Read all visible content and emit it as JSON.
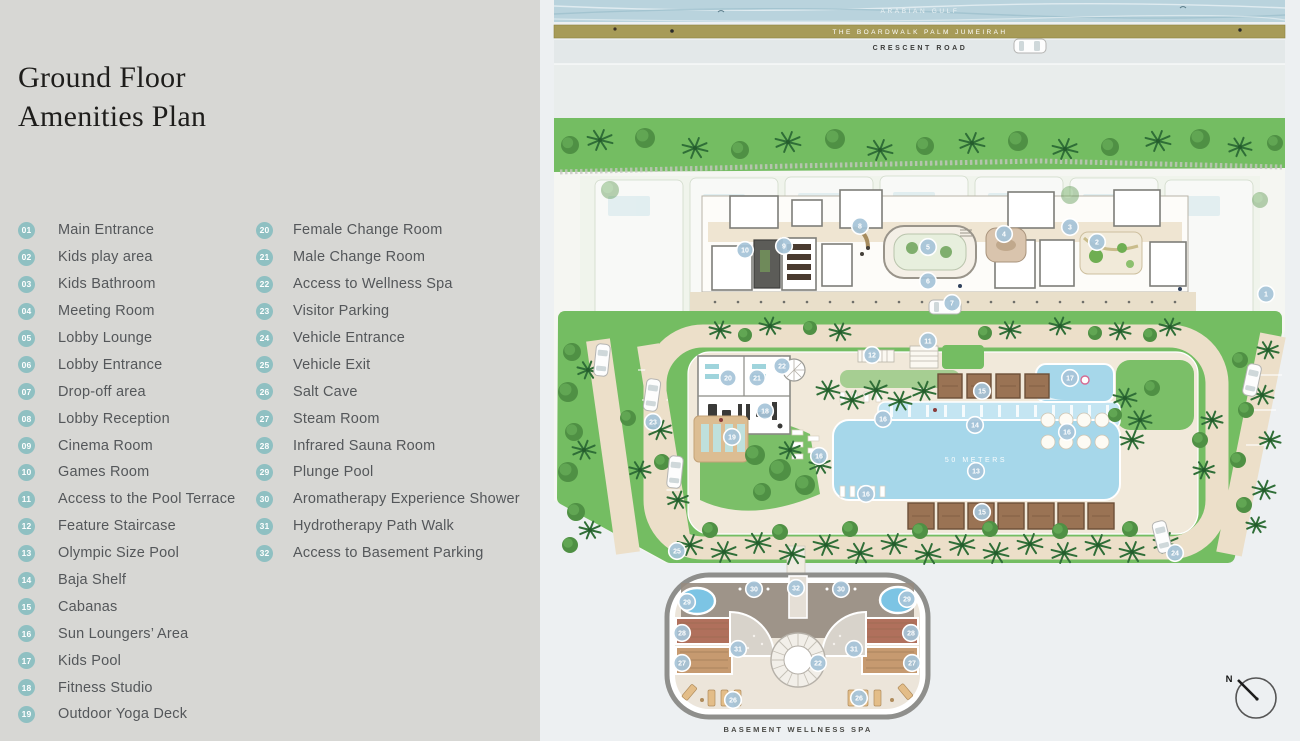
{
  "panel": {
    "title_lines": [
      "Ground Floor",
      "Amenities Plan"
    ]
  },
  "legend": {
    "column1": [
      {
        "num": "01",
        "label": "Main Entrance"
      },
      {
        "num": "02",
        "label": "Kids play area"
      },
      {
        "num": "03",
        "label": "Kids Bathroom"
      },
      {
        "num": "04",
        "label": "Meeting Room"
      },
      {
        "num": "05",
        "label": "Lobby Lounge"
      },
      {
        "num": "06",
        "label": "Lobby Entrance"
      },
      {
        "num": "07",
        "label": "Drop-off area"
      },
      {
        "num": "08",
        "label": "Lobby Reception"
      },
      {
        "num": "09",
        "label": "Cinema Room"
      },
      {
        "num": "10",
        "label": "Games Room"
      },
      {
        "num": "11",
        "label": "Access to the Pool Terrace"
      },
      {
        "num": "12",
        "label": "Feature Staircase"
      },
      {
        "num": "13",
        "label": "Olympic Size Pool"
      },
      {
        "num": "14",
        "label": "Baja Shelf"
      },
      {
        "num": "15",
        "label": "Cabanas"
      },
      {
        "num": "16",
        "label": "Sun Loungers’ Area"
      },
      {
        "num": "17",
        "label": "Kids Pool"
      },
      {
        "num": "18",
        "label": "Fitness Studio"
      },
      {
        "num": "19",
        "label": "Outdoor Yoga Deck"
      }
    ],
    "column2": [
      {
        "num": "20",
        "label": "Female Change Room"
      },
      {
        "num": "21",
        "label": "Male Change Room"
      },
      {
        "num": "22",
        "label": "Access to Wellness Spa"
      },
      {
        "num": "23",
        "label": "Visitor Parking"
      },
      {
        "num": "24",
        "label": "Vehicle Entrance"
      },
      {
        "num": "25",
        "label": "Vehicle Exit"
      },
      {
        "num": "26",
        "label": "Salt Cave"
      },
      {
        "num": "27",
        "label": "Steam Room"
      },
      {
        "num": "28",
        "label": "Infrared Sauna Room"
      },
      {
        "num": "29",
        "label": "Plunge Pool"
      },
      {
        "num": "30",
        "label": "Aromatherapy Experience Shower"
      },
      {
        "num": "31",
        "label": "Hydrotherapy Path Walk"
      },
      {
        "num": "32",
        "label": "Access to Basement Parking"
      }
    ]
  },
  "plan": {
    "water_label": "ARABIAN GULF",
    "boardwalk_label": "THE BOARDWALK PALM JUMEIRAH",
    "road_label": "CRESCENT ROAD",
    "pool_label": "50 METERS",
    "spa_label": "BASEMENT WELLNESS SPA",
    "north_label": "N",
    "markers": [
      {
        "n": "1",
        "x": 726,
        "y": 294
      },
      {
        "n": "2",
        "x": 557,
        "y": 242
      },
      {
        "n": "3",
        "x": 530,
        "y": 227
      },
      {
        "n": "4",
        "x": 464,
        "y": 234
      },
      {
        "n": "5",
        "x": 388,
        "y": 247
      },
      {
        "n": "6",
        "x": 388,
        "y": 281
      },
      {
        "n": "7",
        "x": 412,
        "y": 303
      },
      {
        "n": "8",
        "x": 320,
        "y": 226
      },
      {
        "n": "9",
        "x": 244,
        "y": 246
      },
      {
        "n": "10",
        "x": 205,
        "y": 250
      },
      {
        "n": "11",
        "x": 388,
        "y": 341
      },
      {
        "n": "12",
        "x": 332,
        "y": 355
      },
      {
        "n": "13",
        "x": 436,
        "y": 471
      },
      {
        "n": "14",
        "x": 435,
        "y": 425
      },
      {
        "n": "15",
        "x": 442,
        "y": 391
      },
      {
        "n": "15",
        "x": 442,
        "y": 512
      },
      {
        "n": "16",
        "x": 343,
        "y": 419
      },
      {
        "n": "16",
        "x": 279,
        "y": 456
      },
      {
        "n": "16",
        "x": 527,
        "y": 432
      },
      {
        "n": "16",
        "x": 326,
        "y": 494
      },
      {
        "n": "17",
        "x": 530,
        "y": 378
      },
      {
        "n": "18",
        "x": 225,
        "y": 411
      },
      {
        "n": "19",
        "x": 192,
        "y": 437
      },
      {
        "n": "20",
        "x": 188,
        "y": 378
      },
      {
        "n": "21",
        "x": 217,
        "y": 378
      },
      {
        "n": "22",
        "x": 242,
        "y": 366
      },
      {
        "n": "23",
        "x": 113,
        "y": 422
      },
      {
        "n": "24",
        "x": 635,
        "y": 553
      },
      {
        "n": "25",
        "x": 137,
        "y": 551
      },
      {
        "n": "26",
        "x": 193,
        "y": 700
      },
      {
        "n": "26",
        "x": 319,
        "y": 698
      },
      {
        "n": "27",
        "x": 142,
        "y": 663
      },
      {
        "n": "27",
        "x": 372,
        "y": 663
      },
      {
        "n": "28",
        "x": 142,
        "y": 633
      },
      {
        "n": "28",
        "x": 371,
        "y": 633
      },
      {
        "n": "29",
        "x": 147,
        "y": 602
      },
      {
        "n": "29",
        "x": 367,
        "y": 599
      },
      {
        "n": "30",
        "x": 214,
        "y": 589
      },
      {
        "n": "30",
        "x": 301,
        "y": 589
      },
      {
        "n": "31",
        "x": 198,
        "y": 649
      },
      {
        "n": "31",
        "x": 314,
        "y": 649
      },
      {
        "n": "32",
        "x": 256,
        "y": 588
      },
      {
        "n": "22",
        "x": 278,
        "y": 663
      }
    ]
  },
  "colors": {
    "panel_gray": "#d7d7d4",
    "badge_teal": "#8fc0c2",
    "legend_text": "#54575a",
    "water_blue": "#b9d3dd",
    "boardwalk_tan": "#a79b58",
    "road_gray": "#e3e8e9",
    "lawn_green": "#74bd62",
    "paving_beige": "#ecdfc9",
    "deck_cream": "#f1e9da",
    "pool_blue": "#a6d7ea",
    "marker_blue": "#a6c4d8",
    "cabana_brown": "#9a7354"
  }
}
